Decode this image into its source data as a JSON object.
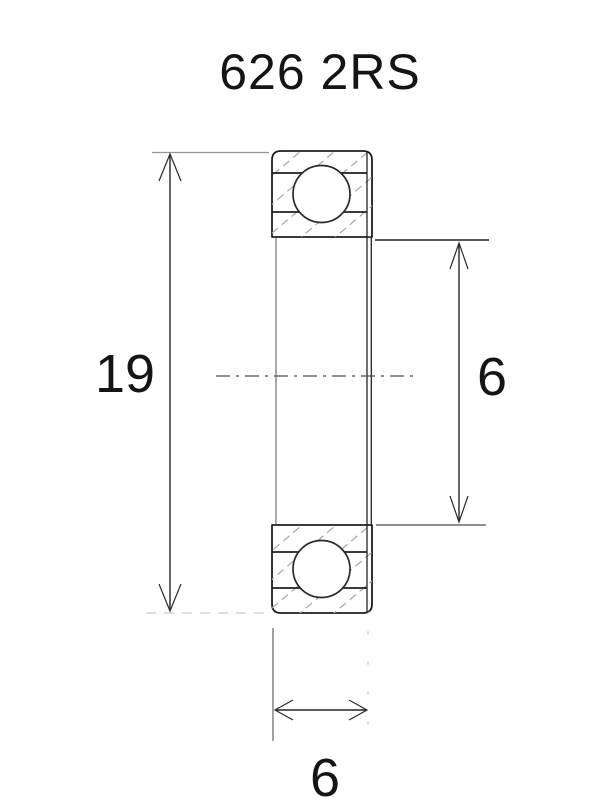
{
  "title": "626 2RS",
  "drawing": {
    "type": "ball-bearing-cross-section",
    "dimensions": {
      "outer_diameter": {
        "value": "19",
        "position": "left"
      },
      "bore_diameter": {
        "value": "6",
        "position": "right"
      },
      "width": {
        "value": "6",
        "position": "bottom"
      }
    }
  },
  "colors": {
    "background": "#ffffff",
    "line": "#1e1e1e",
    "extension_line": "#8f8f8f",
    "hatch": "#a6a6a6",
    "text": "#151515"
  }
}
